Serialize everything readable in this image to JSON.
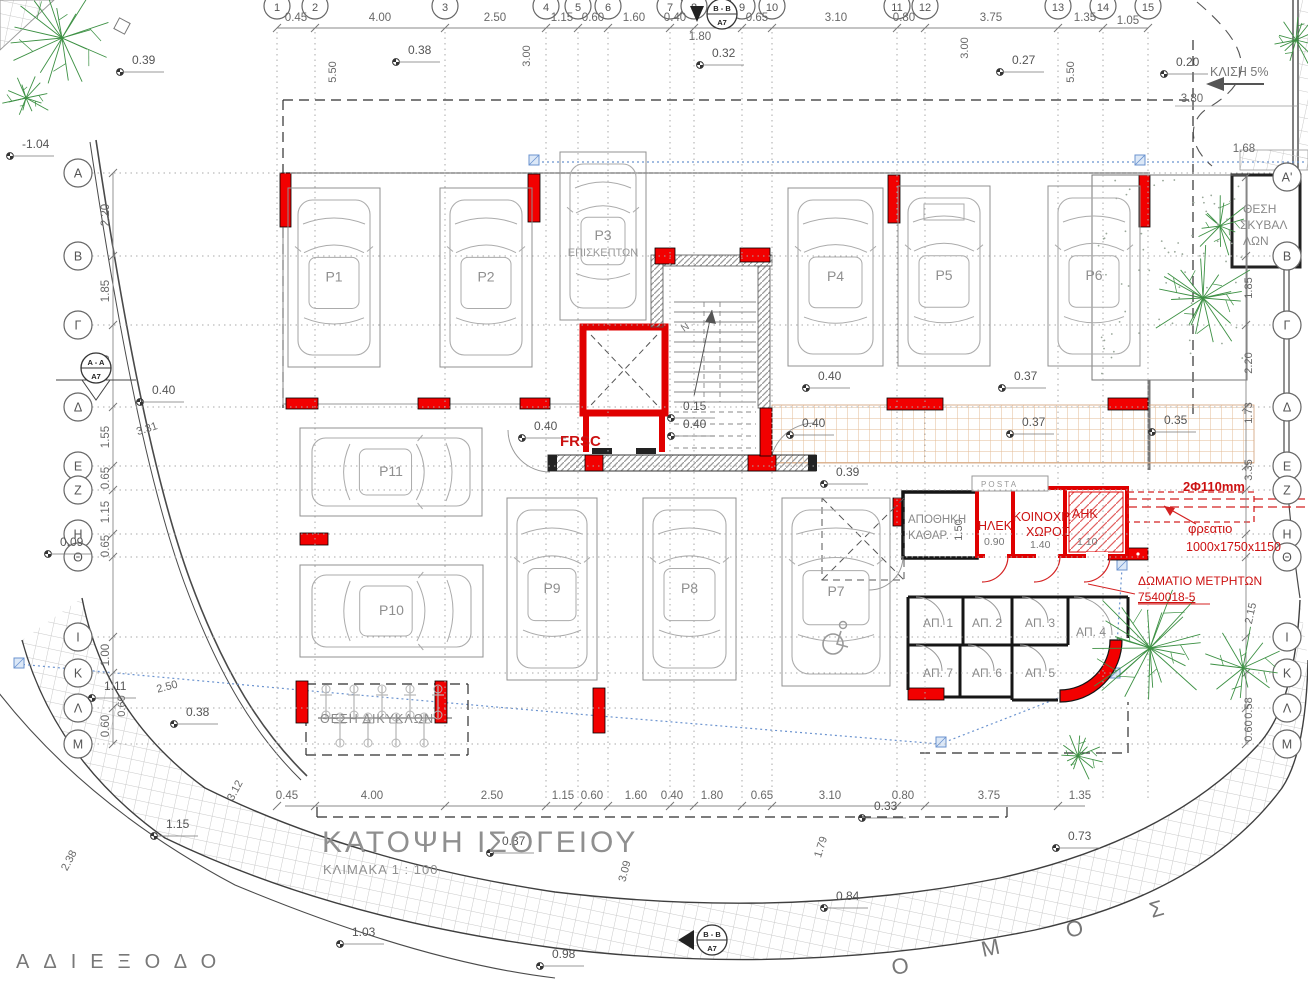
{
  "title": {
    "main": "ΚΑΤΟΨΗ ΙΣΟΓΕΙΟΥ",
    "scale": "ΚΛΙΜΑΚΑ 1 : 100"
  },
  "colors": {
    "red": "#ee0000",
    "red_text": "#cc1111",
    "gray": "#8a8a8a",
    "dim": "#686868",
    "green": "#3c9043",
    "blue": "#6b93cf",
    "tan": "#dfb08a",
    "wall": "#1a1a1a"
  },
  "grid": {
    "columns": [
      {
        "n": "1",
        "x": 277
      },
      {
        "n": "2",
        "x": 315
      },
      {
        "n": "3",
        "x": 445
      },
      {
        "n": "4",
        "x": 546
      },
      {
        "n": "5",
        "x": 578
      },
      {
        "n": "6",
        "x": 608
      },
      {
        "n": "7",
        "x": 670
      },
      {
        "n": "8",
        "x": 694
      },
      {
        "n": "9",
        "x": 742
      },
      {
        "n": "10",
        "x": 772
      },
      {
        "n": "11",
        "x": 897
      },
      {
        "n": "12",
        "x": 925
      },
      {
        "n": "13",
        "x": 1058
      },
      {
        "n": "14",
        "x": 1103
      },
      {
        "n": "15",
        "x": 1148
      }
    ],
    "rows_left": [
      {
        "n": "Α",
        "y": 173
      },
      {
        "n": "Β",
        "y": 256
      },
      {
        "n": "Γ",
        "y": 325
      },
      {
        "n": "Δ",
        "y": 407
      },
      {
        "n": "Ε",
        "y": 466
      },
      {
        "n": "Ζ",
        "y": 490
      },
      {
        "n": "Η",
        "y": 534
      },
      {
        "n": "Θ",
        "y": 557
      },
      {
        "n": "Ι",
        "y": 637
      },
      {
        "n": "Κ",
        "y": 673
      },
      {
        "n": "Λ",
        "y": 708
      },
      {
        "n": "Μ",
        "y": 744
      }
    ],
    "rows_right": [
      {
        "n": "Α'",
        "y": 177
      },
      {
        "n": "Β",
        "y": 256
      },
      {
        "n": "Γ",
        "y": 325
      },
      {
        "n": "Δ",
        "y": 407
      },
      {
        "n": "Ε",
        "y": 466
      },
      {
        "n": "Ζ",
        "y": 490
      },
      {
        "n": "Η",
        "y": 534
      },
      {
        "n": "Θ",
        "y": 557
      },
      {
        "n": "Ι",
        "y": 637
      },
      {
        "n": "Κ",
        "y": 673
      },
      {
        "n": "Λ",
        "y": 708
      },
      {
        "n": "Μ",
        "y": 744
      }
    ]
  },
  "dimensions": {
    "top": [
      {
        "t": "0.45",
        "x": 296
      },
      {
        "t": "4.00",
        "x": 380
      },
      {
        "t": "2.50",
        "x": 495
      },
      {
        "t": "1.15",
        "x": 562
      },
      {
        "t": "0.60",
        "x": 593
      },
      {
        "t": "1.60",
        "x": 634
      },
      {
        "t": "0.40",
        "x": 675
      },
      {
        "t": "0.65",
        "x": 757
      },
      {
        "t": "3.10",
        "x": 836
      },
      {
        "t": "0.80",
        "x": 904
      },
      {
        "t": "3.75",
        "x": 991
      },
      {
        "t": "1.35",
        "x": 1085
      }
    ],
    "top_extra": [
      {
        "t": "1.80",
        "x": 700,
        "y": 40
      },
      {
        "t": "1.05",
        "x": 1128,
        "y": 24
      },
      {
        "t": "3.80",
        "x": 1192,
        "y": 102
      },
      {
        "t": "1.68",
        "x": 1244,
        "y": 152
      }
    ],
    "bottom": [
      {
        "t": "0.45",
        "x": 287
      },
      {
        "t": "4.00",
        "x": 372
      },
      {
        "t": "2.50",
        "x": 492
      },
      {
        "t": "1.15",
        "x": 563
      },
      {
        "t": "0.60",
        "x": 592
      },
      {
        "t": "1.60",
        "x": 636
      },
      {
        "t": "0.40",
        "x": 672
      },
      {
        "t": "1.80",
        "x": 712
      },
      {
        "t": "0.65",
        "x": 762
      },
      {
        "t": "3.10",
        "x": 830
      },
      {
        "t": "0.80",
        "x": 903
      },
      {
        "t": "3.75",
        "x": 989
      },
      {
        "t": "1.35",
        "x": 1080
      }
    ],
    "left": [
      {
        "t": "2.20",
        "y": 215
      },
      {
        "t": "1.85",
        "y": 291
      },
      {
        "t": "2.20",
        "y": 366
      },
      {
        "t": "1.55",
        "y": 437
      },
      {
        "t": "0.65",
        "y": 478
      },
      {
        "t": "1.15",
        "y": 512
      },
      {
        "t": "0.65",
        "y": 546
      },
      {
        "t": "1.00",
        "y": 655
      },
      {
        "t": "0.60",
        "y": 726
      }
    ],
    "right": [
      {
        "t": "1.85",
        "y": 288
      },
      {
        "t": "2.20",
        "y": 363
      },
      {
        "t": "1.73",
        "y": 413
      },
      {
        "t": "3.35",
        "y": 470
      },
      {
        "t": "0.58",
        "y": 708
      },
      {
        "t": "0.60",
        "y": 731
      }
    ],
    "interior": [
      {
        "t": "5.50",
        "x": 336,
        "y": 72,
        "rot": -90
      },
      {
        "t": "3.00",
        "x": 530,
        "y": 56,
        "rot": -90
      },
      {
        "t": "3.00",
        "x": 968,
        "y": 48,
        "rot": -90
      },
      {
        "t": "5.50",
        "x": 1074,
        "y": 72,
        "rot": -90
      },
      {
        "t": "1.50",
        "x": 962,
        "y": 530,
        "rot": -90
      }
    ],
    "skew": [
      {
        "t": "3.31",
        "x": 148,
        "y": 432,
        "rot": -18
      },
      {
        "t": "2.50",
        "x": 168,
        "y": 690,
        "rot": -15
      },
      {
        "t": "2.38",
        "x": 72,
        "y": 862,
        "rot": -62
      },
      {
        "t": "3.12",
        "x": 238,
        "y": 792,
        "rot": -62
      },
      {
        "t": "3.09",
        "x": 628,
        "y": 872,
        "rot": -75
      },
      {
        "t": "1.79",
        "x": 824,
        "y": 848,
        "rot": -72
      },
      {
        "t": "2.15",
        "x": 1254,
        "y": 614,
        "rot": -78
      },
      {
        "t": "0.60",
        "x": 125,
        "y": 706,
        "rot": -90
      }
    ]
  },
  "spot_levels": [
    {
      "v": "0.39",
      "x": 132,
      "y": 64
    },
    {
      "v": "0.38",
      "x": 408,
      "y": 54
    },
    {
      "v": "0.32",
      "x": 712,
      "y": 57
    },
    {
      "v": "0.27",
      "x": 1012,
      "y": 64
    },
    {
      "v": "0.20",
      "x": 1176,
      "y": 66
    },
    {
      "v": "-1.04",
      "x": 22,
      "y": 148
    },
    {
      "v": "0.40",
      "x": 152,
      "y": 394
    },
    {
      "v": "0.40",
      "x": 534,
      "y": 430
    },
    {
      "v": "0.15",
      "x": 683,
      "y": 410
    },
    {
      "v": "0.40",
      "x": 683,
      "y": 428
    },
    {
      "v": "0.40",
      "x": 818,
      "y": 380
    },
    {
      "v": "0.40",
      "x": 802,
      "y": 427
    },
    {
      "v": "0.37",
      "x": 1014,
      "y": 380
    },
    {
      "v": "0.37",
      "x": 1022,
      "y": 426
    },
    {
      "v": "0.35",
      "x": 1164,
      "y": 424
    },
    {
      "v": "0.39",
      "x": 836,
      "y": 476
    },
    {
      "v": "0.09",
      "x": 60,
      "y": 546
    },
    {
      "v": "1.11",
      "x": 104,
      "y": 690
    },
    {
      "v": "0.38",
      "x": 186,
      "y": 716
    },
    {
      "v": "1.15",
      "x": 166,
      "y": 828
    },
    {
      "v": "0.37",
      "x": 502,
      "y": 845
    },
    {
      "v": "0.33",
      "x": 874,
      "y": 810
    },
    {
      "v": "0.73",
      "x": 1068,
      "y": 840
    },
    {
      "v": "0.84",
      "x": 836,
      "y": 900
    },
    {
      "v": "0.98",
      "x": 552,
      "y": 958
    },
    {
      "v": "1.03",
      "x": 352,
      "y": 936
    }
  ],
  "parking": {
    "spots": [
      {
        "id": "P1",
        "x": 288,
        "y": 188,
        "w": 92,
        "h": 179,
        "dir": "v"
      },
      {
        "id": "P2",
        "x": 440,
        "y": 188,
        "w": 92,
        "h": 179,
        "dir": "v"
      },
      {
        "id": "P3",
        "x": 560,
        "y": 152,
        "w": 86,
        "h": 168,
        "dir": "v",
        "note": "ΕΠΙΣΚΕΠΤΩΝ"
      },
      {
        "id": "P4",
        "x": 788,
        "y": 188,
        "w": 95,
        "h": 178,
        "dir": "v"
      },
      {
        "id": "P5",
        "x": 898,
        "y": 186,
        "w": 92,
        "h": 180,
        "dir": "v",
        "van": true
      },
      {
        "id": "P6",
        "x": 1048,
        "y": 186,
        "w": 92,
        "h": 180,
        "dir": "v"
      },
      {
        "id": "P11",
        "x": 300,
        "y": 428,
        "w": 182,
        "h": 88,
        "dir": "h"
      },
      {
        "id": "P10",
        "x": 300,
        "y": 565,
        "w": 183,
        "h": 92,
        "dir": "h"
      },
      {
        "id": "P9",
        "x": 507,
        "y": 498,
        "w": 90,
        "h": 182,
        "dir": "v"
      },
      {
        "id": "P8",
        "x": 643,
        "y": 498,
        "w": 93,
        "h": 182,
        "dir": "v"
      },
      {
        "id": "P7",
        "x": 782,
        "y": 498,
        "w": 108,
        "h": 188,
        "dir": "v",
        "accessible": true
      }
    ]
  },
  "storage_rooms": [
    {
      "id": "ΑΠ. 1",
      "x": 923,
      "y": 627
    },
    {
      "id": "ΑΠ. 2",
      "x": 972,
      "y": 627
    },
    {
      "id": "ΑΠ. 3",
      "x": 1025,
      "y": 627
    },
    {
      "id": "ΑΠ. 4",
      "x": 1076,
      "y": 636
    },
    {
      "id": "ΑΠ. 7",
      "x": 923,
      "y": 677
    },
    {
      "id": "ΑΠ. 6",
      "x": 972,
      "y": 677
    },
    {
      "id": "ΑΠ. 5",
      "x": 1025,
      "y": 677
    }
  ],
  "texts": [
    {
      "t": "ΘΕΣΗ ΔΙΚΥΚΛΩΝ",
      "x": 320,
      "y": 723,
      "size": 12.5,
      "color": "#8a8a8a",
      "ls": 1
    },
    {
      "t": "ΘΕΣΗ",
      "x": 1243,
      "y": 213,
      "size": 12,
      "color": "#8a8a8a"
    },
    {
      "t": "ΣΚΥΒΑΛ",
      "x": 1240,
      "y": 229,
      "size": 12,
      "color": "#8a8a8a"
    },
    {
      "t": "ΛΩΝ",
      "x": 1243,
      "y": 245,
      "size": 12,
      "color": "#8a8a8a"
    },
    {
      "t": "ΑΠΟΘΗΚΗ",
      "x": 908,
      "y": 523,
      "size": 11.5,
      "color": "#8a8a8a"
    },
    {
      "t": "ΚΑΘΑΡ.",
      "x": 908,
      "y": 539,
      "size": 11.5,
      "color": "#8a8a8a"
    },
    {
      "t": "P O S T A",
      "x": 981,
      "y": 487,
      "size": 8,
      "color": "#999999"
    },
    {
      "t": "ΚΛΙΣΗ 5%",
      "x": 1210,
      "y": 76,
      "size": 12.5,
      "color": "#777777"
    },
    {
      "t": "0.90",
      "x": 984,
      "y": 545,
      "size": 10.5,
      "color": "#777777"
    },
    {
      "t": "1.40",
      "x": 1030,
      "y": 548,
      "size": 10.5,
      "color": "#777777"
    },
    {
      "t": "1.10",
      "x": 1077,
      "y": 545,
      "size": 10.5,
      "color": "#777777"
    },
    {
      "t": "Ο",
      "x": 893,
      "y": 975,
      "size": 22,
      "color": "#777777",
      "rot": -10
    },
    {
      "t": "Μ",
      "x": 983,
      "y": 957,
      "size": 22,
      "color": "#777777",
      "rot": -12
    },
    {
      "t": "Ο",
      "x": 1068,
      "y": 938,
      "size": 22,
      "color": "#777777",
      "rot": -14
    },
    {
      "t": "Σ",
      "x": 1152,
      "y": 918,
      "size": 22,
      "color": "#777777",
      "rot": -16
    },
    {
      "t": "Ν",
      "x": 684,
      "y": 332,
      "size": 10,
      "color": "#777777",
      "rot": -35
    }
  ],
  "red_texts": [
    {
      "t": "FRSC",
      "x": 560,
      "y": 446,
      "size": 15,
      "bold": true
    },
    {
      "t": "ΗΛΕΚ.",
      "x": 978,
      "y": 530,
      "size": 12.5
    },
    {
      "t": "ΚΟΙΝΟΧΡ.",
      "x": 1013,
      "y": 521,
      "size": 12.5
    },
    {
      "t": "ΧΩΡΟΣ",
      "x": 1026,
      "y": 536,
      "size": 12.5
    },
    {
      "t": "ΑΗΚ",
      "x": 1072,
      "y": 518,
      "size": 12.5
    },
    {
      "t": "2Φ110mm",
      "x": 1183,
      "y": 491,
      "size": 13,
      "bold": true
    },
    {
      "t": "φρεατιο",
      "x": 1188,
      "y": 533,
      "size": 13
    },
    {
      "t": "1000x1750x1150",
      "x": 1186,
      "y": 551,
      "size": 12.5
    },
    {
      "t": "ΔΩΜΑΤΙΟ ΜΕΤΡΗΤΩΝ",
      "x": 1138,
      "y": 585,
      "size": 12
    },
    {
      "t": "7540018-5",
      "x": 1138,
      "y": 601,
      "size": 12,
      "underline": true
    }
  ],
  "dead_end_label": "ΑΔΙΕΞΟΔΟ",
  "section_markers": [
    {
      "l1": "B - B",
      "l2": "A7",
      "x": 722,
      "y": 14,
      "tri": "down"
    },
    {
      "l1": "A - A",
      "l2": "A7",
      "x": 96,
      "y": 368,
      "tri": "downbig"
    },
    {
      "l1": "B - B",
      "l2": "A7",
      "x": 712,
      "y": 940,
      "tri": "left"
    }
  ],
  "trees": [
    {
      "x": 62,
      "y": 38,
      "r": 54
    },
    {
      "x": 26,
      "y": 98,
      "r": 26
    },
    {
      "x": 1203,
      "y": 298,
      "r": 60
    },
    {
      "x": 1220,
      "y": 226,
      "r": 36
    },
    {
      "x": 1150,
      "y": 648,
      "r": 72
    },
    {
      "x": 1243,
      "y": 668,
      "r": 42
    },
    {
      "x": 1078,
      "y": 756,
      "r": 26
    },
    {
      "x": 1296,
      "y": 40,
      "r": 28
    }
  ]
}
